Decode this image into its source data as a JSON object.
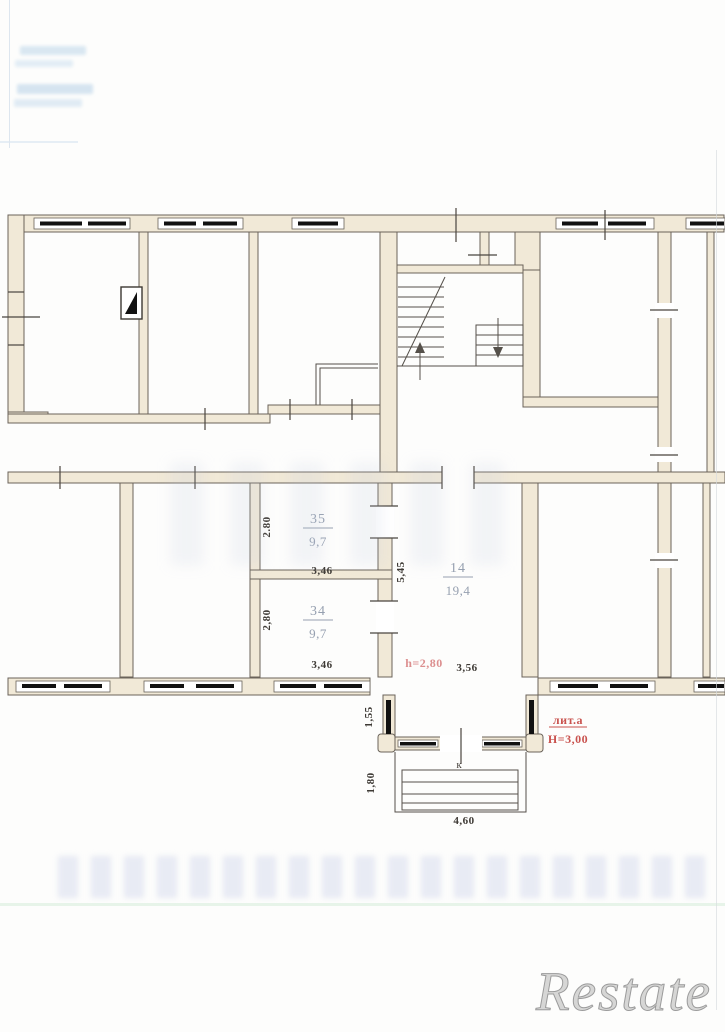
{
  "watermark": "Restate",
  "plan": {
    "rooms": {
      "r35": {
        "number": "35",
        "area": "9,7",
        "width": "3,46",
        "depth": "2.80"
      },
      "r34": {
        "number": "34",
        "area": "9,7",
        "width": "3,46",
        "depth": "2,80"
      },
      "r14": {
        "number": "14",
        "area": "19,4",
        "width": "3,56",
        "depth": "5,45",
        "ceiling_height": "h=2,80"
      }
    },
    "annotations": {
      "liter": "лит.а",
      "building_height": "Н=3,00",
      "porch_label": "к",
      "porch_width": "4,60",
      "vestibule_depth": "1,55",
      "porch_depth": "1,80"
    },
    "colors": {
      "wall_fill": "#f1e9d7",
      "wall_stroke": "#6a635a",
      "window_bar": "#111111",
      "room_label": "#96a0b0",
      "dimension_text": "#3e3a35",
      "red_note": "#c9524e",
      "pink_note": "#dc8f8f"
    }
  }
}
